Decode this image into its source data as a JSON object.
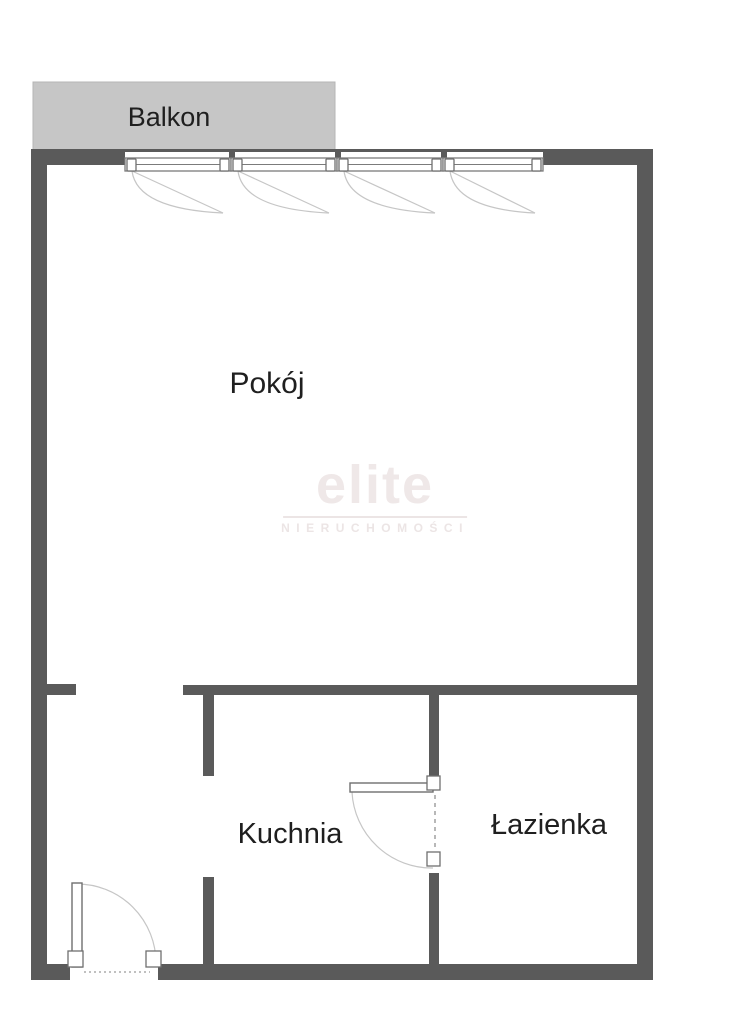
{
  "plan": {
    "type": "apartment-floor-plan",
    "rooms": {
      "balcony_label": "Balkon",
      "living_label": "Pokój",
      "kitchen_label": "Kuchnia",
      "bathroom_label": "Łazienka"
    },
    "fixtures": {
      "windows_count": 4,
      "doors": [
        "entry-door",
        "bathroom-door"
      ]
    }
  },
  "watermark": {
    "brand": "elite",
    "subtitle": "NIERUCHOMOŚCI"
  },
  "colors": {
    "wall": "#5a5a5a",
    "balcony_fill": "#c6c6c6",
    "balcony_border": "#b5b5b5",
    "label_text": "#1f1f1f",
    "swing_line": "#c6c6c6",
    "watermark_text": "#efe8e8"
  }
}
